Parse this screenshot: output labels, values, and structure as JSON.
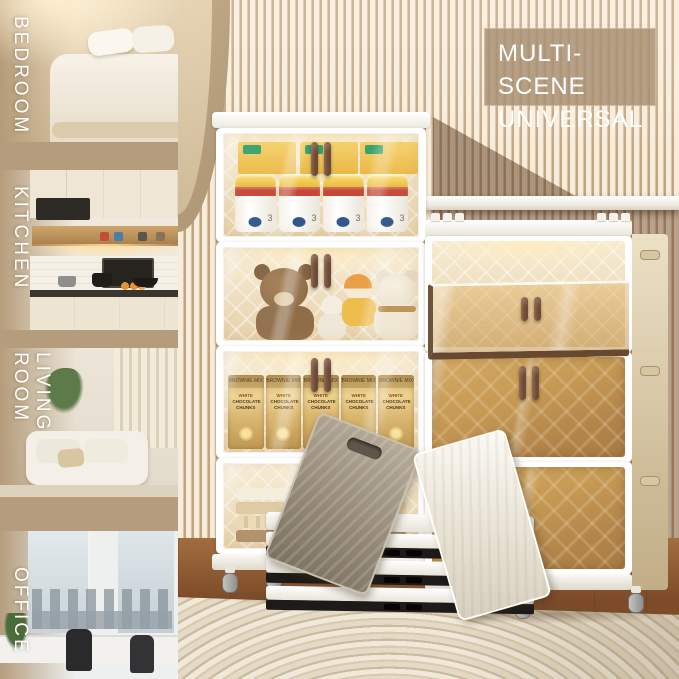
{
  "overlay": {
    "line1": "MULTI-SCENE",
    "line2": "UNIVERSAL"
  },
  "sidebar": {
    "items": [
      {
        "label": "BEDROOM"
      },
      {
        "label": "KITCHEN"
      },
      {
        "label": "LIVING ROOM"
      },
      {
        "label": "OFFICE"
      }
    ]
  },
  "cabinets": {
    "left": {
      "unit_contents": [
        "milk powder cans",
        "plush teddy bears",
        "snack bags",
        "folded towels"
      ]
    },
    "right": {
      "unit_states": [
        "open",
        "closed",
        "closed"
      ]
    }
  },
  "packaging": {
    "bag_top_text": "BROWNIE MIX",
    "bag_label_line1": "WHITE",
    "bag_label_line2": "CHOCOLATE",
    "bag_label_line3": "CHUNKS",
    "milk_can_stage": "3"
  },
  "colors": {
    "sidebar_tan": "#b49c7c",
    "wall_slat_light": "#f6ecdb",
    "wall_slat_dark": "#c2a380",
    "amber_door": "#c79b55",
    "handle_brown": "#6b4630",
    "text_white": "#ffffff"
  }
}
